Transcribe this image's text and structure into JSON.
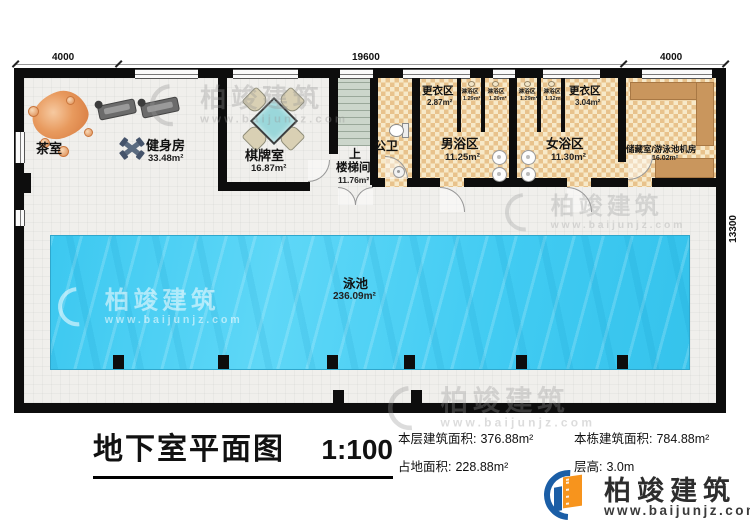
{
  "plan": {
    "dimensions": {
      "top_left": "4000",
      "top_center": "19600",
      "top_right": "4000",
      "right_side": "13300"
    },
    "rooms": {
      "tea": {
        "name": "茶室"
      },
      "gym": {
        "name": "健身房",
        "area": "33.48m²"
      },
      "chess": {
        "name": "棋牌室",
        "area": "16.87m²"
      },
      "stair": {
        "direction": "上",
        "name": "楼梯间",
        "area": "11.76m²"
      },
      "wc": {
        "name": "公卫"
      },
      "changing_men": {
        "name": "更衣区",
        "area": "2.87m²"
      },
      "changing_women": {
        "name": "更衣区",
        "area": "3.04m²"
      },
      "showers": [
        {
          "name": "淋浴区",
          "area": "1.29m²"
        },
        {
          "name": "淋浴区",
          "area": "1.20m²"
        },
        {
          "name": "淋浴区",
          "area": "1.29m²"
        },
        {
          "name": "淋浴区",
          "area": "1.12m²"
        }
      ],
      "men_bath": {
        "name": "男浴区",
        "area": "11.25m²"
      },
      "women_bath": {
        "name": "女浴区",
        "area": "11.30m²"
      },
      "storage": {
        "name": "储藏室/游泳池机房",
        "area": "16.02m²"
      },
      "pool": {
        "name": "泳池",
        "area": "236.09m²"
      }
    }
  },
  "titleblock": {
    "title": "地下室平面图",
    "scale": "1:100",
    "stats": [
      {
        "label": "本层建筑面积:",
        "value": "376.88m²"
      },
      {
        "label": "本栋建筑面积:",
        "value": "784.88m²"
      },
      {
        "label": "占地面积:",
        "value": "228.88m²"
      },
      {
        "label": "层高:",
        "value": "3.0m"
      }
    ]
  },
  "branding": {
    "name": "柏竣建筑",
    "website": "www.baijunjz.com"
  },
  "watermark": {
    "name": "柏竣建筑",
    "website": "www.baijunjz.com"
  },
  "colors": {
    "wall": "#0d0d0d",
    "pool_water": "#45cdf2",
    "bath_tile": "#e8c28c",
    "shelf_wood": "#c9965d",
    "logo_blue": "#1b5ea6",
    "logo_orange": "#f7941d"
  }
}
